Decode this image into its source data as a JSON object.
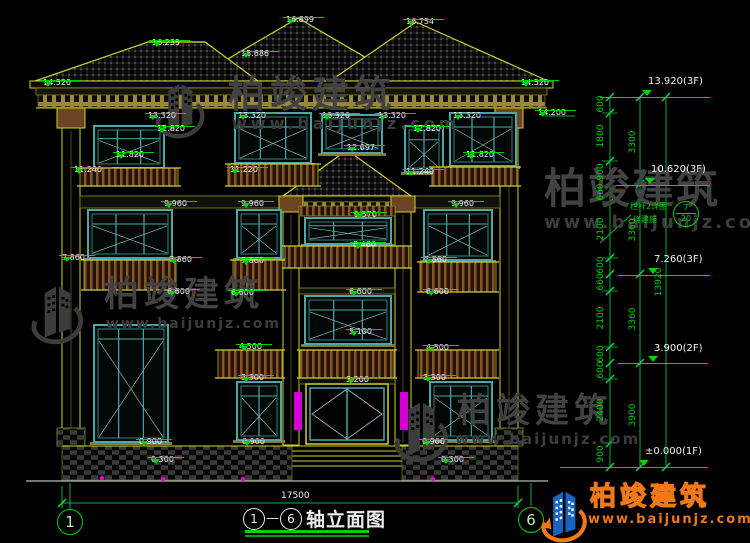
{
  "title": {
    "axis_from": "1",
    "separator": "—",
    "axis_to": "6",
    "text": "轴立面图",
    "overall_dim": "17500"
  },
  "axes": {
    "left": "1",
    "right": "6"
  },
  "watermark": {
    "brand": "柏竣建筑",
    "url": "www.baijunjz.com"
  },
  "brand_logo": {
    "brand": "柏竣建筑",
    "url": "www.baijunjz.com"
  },
  "callout": {
    "line1": "栏杆2详图",
    "line2": "详建施",
    "top": "7",
    "bottom": "20"
  },
  "drawing": {
    "elevation_flags": [
      {
        "t": "16.235",
        "x": 152,
        "y": 30
      },
      {
        "t": "16.899",
        "x": 286,
        "y": 7
      },
      {
        "t": "16.754",
        "x": 406,
        "y": 9
      },
      {
        "t": "15.686",
        "x": 241,
        "y": 41
      },
      {
        "t": "14.520",
        "x": 43,
        "y": 70
      },
      {
        "t": "14.520",
        "x": 521,
        "y": 70
      },
      {
        "t": "14.200",
        "x": 538,
        "y": 100
      },
      {
        "t": "13.320",
        "x": 148,
        "y": 103
      },
      {
        "t": "13.320",
        "x": 238,
        "y": 103
      },
      {
        "t": "13.320",
        "x": 322,
        "y": 103
      },
      {
        "t": "13.320",
        "x": 378,
        "y": 103
      },
      {
        "t": "13.320",
        "x": 453,
        "y": 103
      },
      {
        "t": "12.820",
        "x": 157,
        "y": 116
      },
      {
        "t": "12.820",
        "x": 413,
        "y": 116
      },
      {
        "t": "12.097",
        "x": 347,
        "y": 135
      },
      {
        "t": "11.820",
        "x": 116,
        "y": 142
      },
      {
        "t": "11.820",
        "x": 466,
        "y": 142
      },
      {
        "t": "11.240",
        "x": 74,
        "y": 157
      },
      {
        "t": "11.240",
        "x": 406,
        "y": 159
      },
      {
        "t": "11.220",
        "x": 230,
        "y": 157
      },
      {
        "t": "9.960",
        "x": 164,
        "y": 191
      },
      {
        "t": "9.960",
        "x": 241,
        "y": 191
      },
      {
        "t": "9.960",
        "x": 451,
        "y": 191
      },
      {
        "t": "9.570",
        "x": 354,
        "y": 202
      },
      {
        "t": "8.460",
        "x": 353,
        "y": 232
      },
      {
        "t": "7.860",
        "x": 62,
        "y": 245
      },
      {
        "t": "7.860",
        "x": 169,
        "y": 247
      },
      {
        "t": "7.860",
        "x": 241,
        "y": 248
      },
      {
        "t": "7.860",
        "x": 424,
        "y": 247
      },
      {
        "t": "6.600",
        "x": 167,
        "y": 279
      },
      {
        "t": "6.600",
        "x": 231,
        "y": 280
      },
      {
        "t": "6.600",
        "x": 349,
        "y": 279
      },
      {
        "t": "6.600",
        "x": 426,
        "y": 279
      },
      {
        "t": "5.100",
        "x": 349,
        "y": 319
      },
      {
        "t": "4.500",
        "x": 239,
        "y": 334
      },
      {
        "t": "4.500",
        "x": 426,
        "y": 335
      },
      {
        "t": "3.300",
        "x": 241,
        "y": 365
      },
      {
        "t": "3.300",
        "x": 423,
        "y": 365
      },
      {
        "t": "3.200",
        "x": 346,
        "y": 367
      },
      {
        "t": "0.900",
        "x": 139,
        "y": 429
      },
      {
        "t": "0.900",
        "x": 242,
        "y": 429
      },
      {
        "t": "0.900",
        "x": 422,
        "y": 429
      },
      {
        "t": "0.300",
        "x": 151,
        "y": 447
      },
      {
        "t": "0.300",
        "x": 441,
        "y": 447
      }
    ],
    "right_levels": [
      {
        "t": "13.920(3F)",
        "x": 648,
        "y": 76,
        "x1": 600,
        "x2": 710,
        "ly": 97
      },
      {
        "t": "10.620(3F)",
        "x": 651,
        "y": 164,
        "x1": 616,
        "x2": 710,
        "ly": 185
      },
      {
        "t": "7.260(3F)",
        "x": 654,
        "y": 254,
        "x1": 618,
        "x2": 710,
        "ly": 275
      },
      {
        "t": "3.900(2F)",
        "x": 654,
        "y": 343,
        "x1": 618,
        "x2": 708,
        "ly": 363
      },
      {
        "t": "±0.000(1F)",
        "x": 645,
        "y": 446,
        "x1": 560,
        "x2": 708,
        "ly": 467
      }
    ],
    "chain_inner": [
      {
        "t": "600",
        "y": 105
      },
      {
        "t": "1800",
        "y": 137
      },
      {
        "t": "900",
        "y": 173
      },
      {
        "t": "660",
        "y": 193
      },
      {
        "t": "2100",
        "y": 230
      },
      {
        "t": "600",
        "y": 266
      },
      {
        "t": "660",
        "y": 283
      },
      {
        "t": "2100",
        "y": 319
      },
      {
        "t": "600",
        "y": 355
      },
      {
        "t": "600",
        "y": 371
      },
      {
        "t": "2400",
        "y": 411
      },
      {
        "t": "900",
        "y": 455
      }
    ],
    "chain_mid": [
      {
        "t": "3300",
        "y": 143
      },
      {
        "t": "3360",
        "y": 231
      },
      {
        "t": "3360",
        "y": 320
      },
      {
        "t": "3900",
        "y": 416
      }
    ],
    "chain_total": {
      "t": "13920",
      "y": 283
    }
  }
}
